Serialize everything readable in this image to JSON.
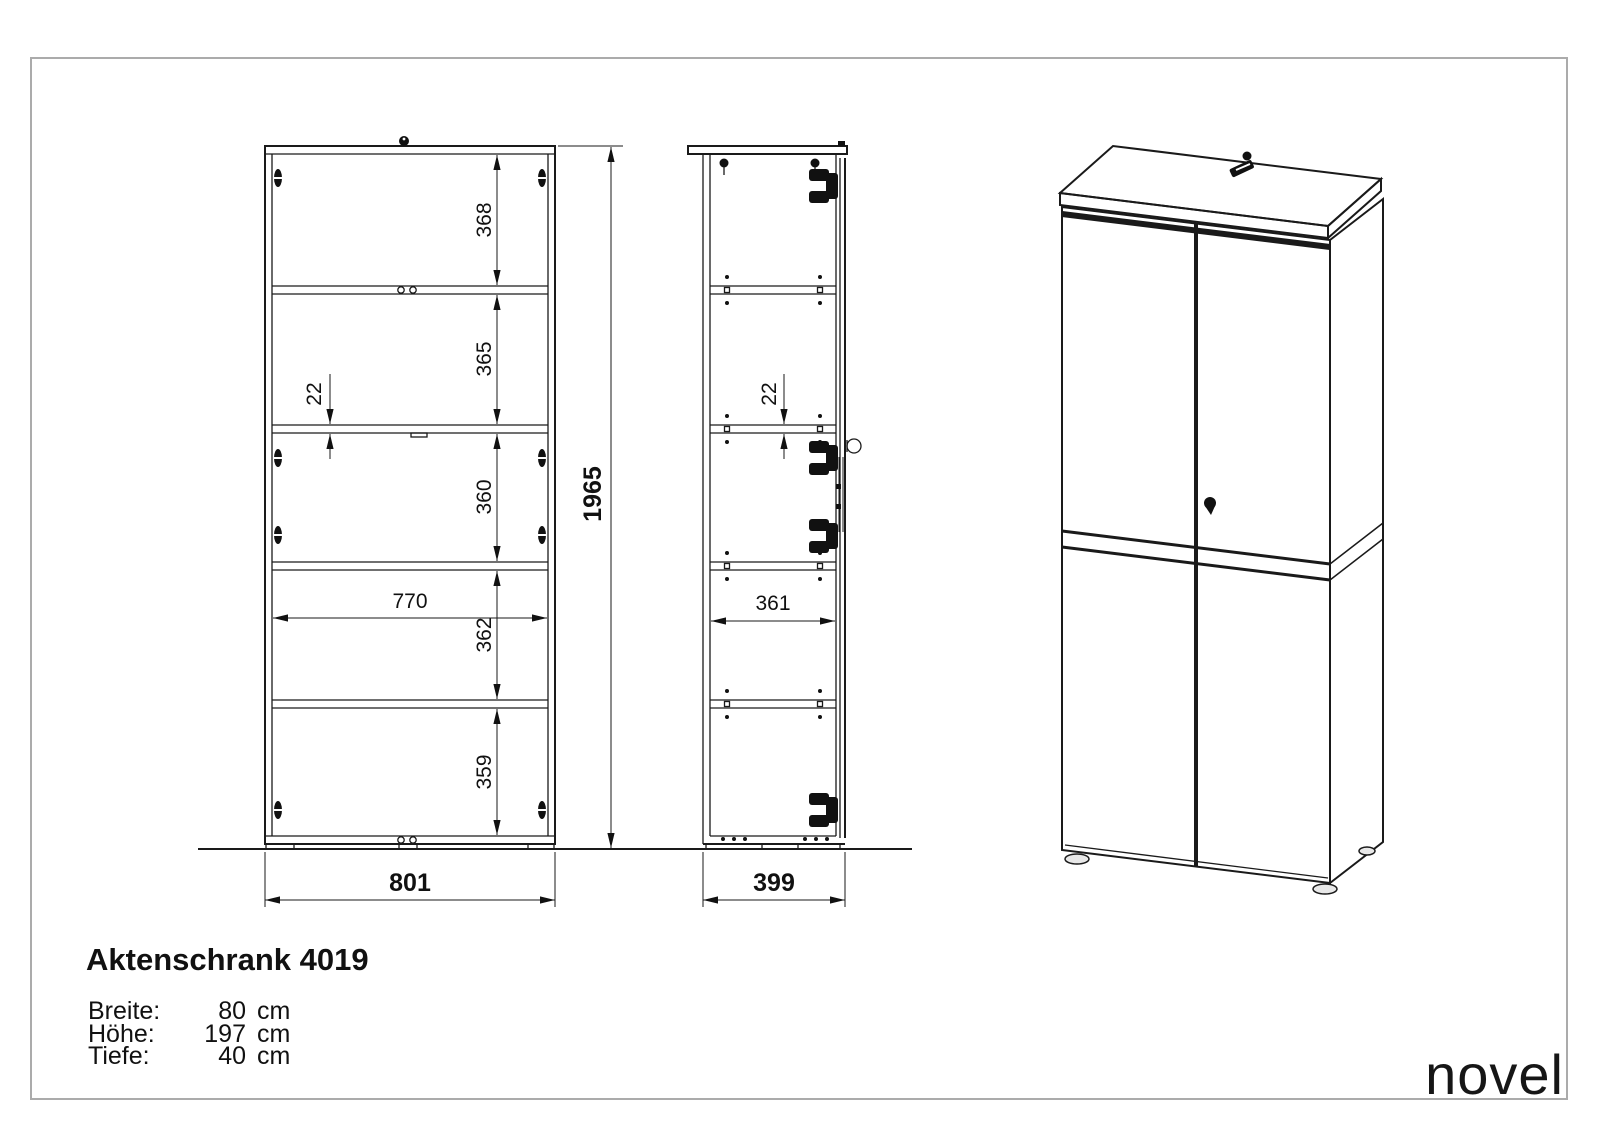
{
  "drawing": {
    "front_view": {
      "compartment_heights": [
        "368",
        "365",
        "360",
        "362",
        "359"
      ],
      "shelf_thickness": "22",
      "inner_width": "770",
      "overall_width": "801",
      "overall_height": "1965"
    },
    "side_view": {
      "shelf_thickness": "22",
      "inner_depth": "361",
      "overall_depth": "399"
    }
  },
  "title_block": {
    "product_title": "Aktenschrank 4019",
    "specs": [
      {
        "label": "Breite:",
        "value": "80",
        "unit": "cm"
      },
      {
        "label": "Höhe:",
        "value": "197",
        "unit": "cm"
      },
      {
        "label": "Tiefe:",
        "value": "40",
        "unit": "cm"
      }
    ],
    "brand": "novel"
  },
  "colors": {
    "line": "#1a1a1a",
    "border": "#ababab"
  }
}
